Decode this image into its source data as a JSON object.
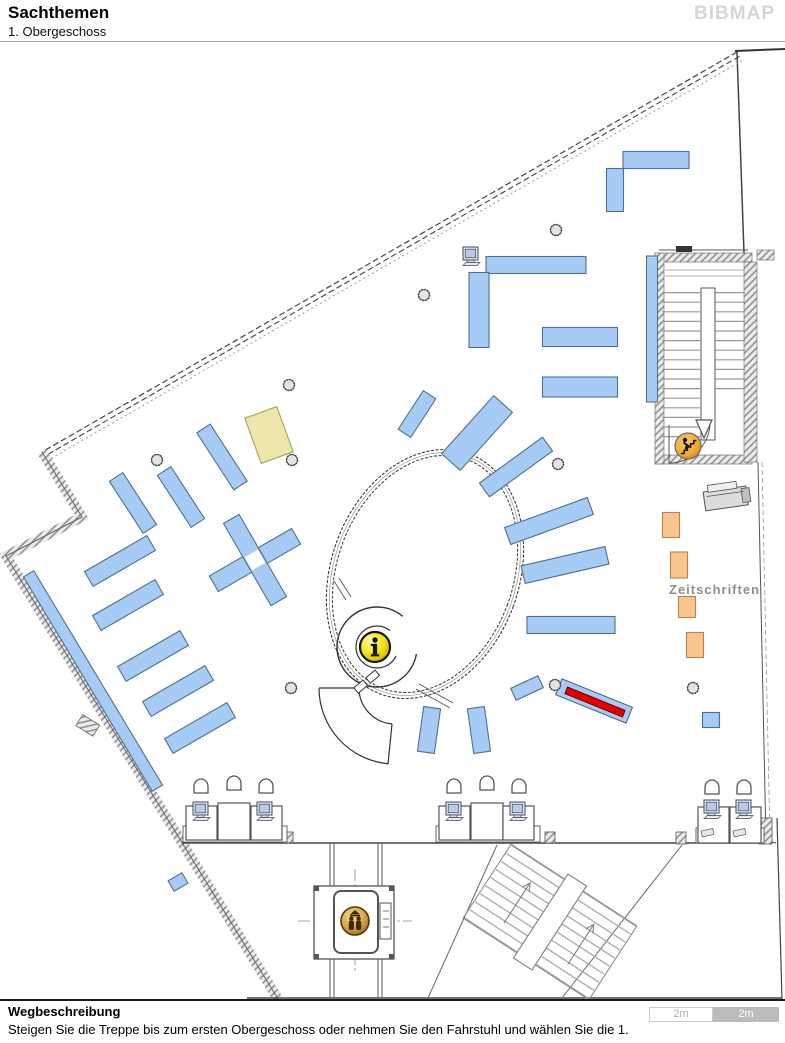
{
  "header": {
    "title": "Sachthemen",
    "subtitle": "1. Obergeschoss",
    "logo": "BIBMAP"
  },
  "footer": {
    "heading": "Wegbeschreibung",
    "instruction": "Steigen Sie die Treppe bis zum ersten Obergeschoss oder nehmen Sie den Fahrstuhl und wählen Sie die 1."
  },
  "scalebar": {
    "segments": [
      {
        "label": "2m",
        "style": "light"
      },
      {
        "label": "2m",
        "style": "dark"
      }
    ]
  },
  "map": {
    "palette": {
      "blue": {
        "fill": "#A6CCF5",
        "stroke": "#50708F"
      },
      "yellow": {
        "fill": "#EDE7AB",
        "stroke": "#A8A162"
      },
      "orange": {
        "fill": "#F9C68E",
        "stroke": "#B5854C"
      },
      "red": {
        "fill": "#E60000",
        "stroke": "#7A0000"
      },
      "white": {
        "fill": "#FFFFFF",
        "stroke": "#FFFFFF"
      }
    },
    "labels": {
      "zeitschriften": {
        "text": "Zeitschriften"
      }
    },
    "shelves": [
      {
        "x": 656,
        "y": 160,
        "w": 66,
        "h": 17,
        "r": 0,
        "type": "blue"
      },
      {
        "x": 615,
        "y": 190,
        "w": 17,
        "h": 43,
        "r": 0,
        "type": "blue"
      },
      {
        "x": 536,
        "y": 265,
        "w": 100,
        "h": 17,
        "r": 0,
        "type": "blue"
      },
      {
        "x": 479,
        "y": 310,
        "w": 20,
        "h": 75,
        "r": 0,
        "type": "blue"
      },
      {
        "x": 580,
        "y": 337,
        "w": 75,
        "h": 19,
        "r": 0,
        "type": "blue"
      },
      {
        "x": 580,
        "y": 387,
        "w": 75,
        "h": 20,
        "r": 0,
        "type": "blue"
      },
      {
        "x": 652,
        "y": 329,
        "w": 11,
        "h": 146,
        "r": 0,
        "type": "blue"
      },
      {
        "x": 417,
        "y": 414,
        "w": 15,
        "h": 46,
        "r": 33,
        "type": "blue"
      },
      {
        "x": 477,
        "y": 433,
        "w": 25,
        "h": 78,
        "r": 42,
        "type": "blue"
      },
      {
        "x": 516,
        "y": 467,
        "w": 17,
        "h": 78,
        "r": 54,
        "type": "blue"
      },
      {
        "x": 549,
        "y": 521,
        "w": 18,
        "h": 88,
        "r": 70,
        "type": "blue"
      },
      {
        "x": 565,
        "y": 565,
        "w": 18,
        "h": 86,
        "r": 77,
        "type": "blue"
      },
      {
        "x": 571,
        "y": 625,
        "w": 88,
        "h": 17,
        "r": 0,
        "type": "blue"
      },
      {
        "x": 527,
        "y": 688,
        "w": 13,
        "h": 30,
        "r": 65,
        "type": "blue"
      },
      {
        "x": 594,
        "y": 701,
        "w": 76,
        "h": 17,
        "r": 22,
        "type": "blue"
      },
      {
        "x": 595,
        "y": 702,
        "w": 62,
        "h": 7,
        "r": 22,
        "type": "red",
        "name": "highlighted-shelf-marker"
      },
      {
        "x": 429,
        "y": 730,
        "w": 17,
        "h": 45,
        "r": 8,
        "type": "blue"
      },
      {
        "x": 479,
        "y": 730,
        "w": 17,
        "h": 45,
        "r": -8,
        "type": "blue"
      },
      {
        "x": 133,
        "y": 503,
        "w": 16,
        "h": 62,
        "r": -33,
        "type": "blue"
      },
      {
        "x": 120,
        "y": 561,
        "w": 72,
        "h": 17,
        "r": -30,
        "type": "blue"
      },
      {
        "x": 181,
        "y": 497,
        "w": 16,
        "h": 62,
        "r": -33,
        "type": "blue"
      },
      {
        "x": 222,
        "y": 457,
        "w": 16,
        "h": 68,
        "r": -33,
        "type": "blue"
      },
      {
        "x": 269,
        "y": 435,
        "w": 34,
        "h": 48,
        "r": -20,
        "type": "yellow"
      },
      {
        "x": 128,
        "y": 605,
        "w": 72,
        "h": 17,
        "r": -30,
        "type": "blue"
      },
      {
        "x": 153,
        "y": 656,
        "w": 72,
        "h": 17,
        "r": -30,
        "type": "blue"
      },
      {
        "x": 178,
        "y": 691,
        "w": 72,
        "h": 17,
        "r": -30,
        "type": "blue"
      },
      {
        "x": 200,
        "y": 728,
        "w": 72,
        "h": 17,
        "r": -30,
        "type": "blue"
      },
      {
        "x": 93,
        "y": 681,
        "w": 12,
        "h": 250,
        "r": -31,
        "type": "blue"
      },
      {
        "x": 255,
        "y": 560,
        "w": 95,
        "h": 18,
        "r": -30,
        "type": "blue"
      },
      {
        "x": 255,
        "y": 560,
        "w": 18,
        "h": 95,
        "r": -30,
        "type": "blue"
      },
      {
        "x": 255,
        "y": 560,
        "w": 14,
        "h": 14,
        "r": -30,
        "type": "white"
      },
      {
        "x": 178,
        "y": 882,
        "w": 16,
        "h": 12,
        "r": -30,
        "type": "blue"
      },
      {
        "x": 711,
        "y": 720,
        "w": 17,
        "h": 15,
        "r": 0,
        "type": "blue"
      },
      {
        "x": 671,
        "y": 525,
        "w": 17,
        "h": 25,
        "r": 0,
        "type": "orange"
      },
      {
        "x": 679,
        "y": 565,
        "w": 17,
        "h": 26,
        "r": 0,
        "type": "orange"
      },
      {
        "x": 687,
        "y": 607,
        "w": 17,
        "h": 21,
        "r": 0,
        "type": "orange"
      },
      {
        "x": 695,
        "y": 645,
        "w": 17,
        "h": 25,
        "r": 0,
        "type": "orange"
      }
    ],
    "columns": [
      [
        556,
        230
      ],
      [
        424,
        295
      ],
      [
        289,
        385
      ],
      [
        157,
        460
      ],
      [
        292,
        460
      ],
      [
        558,
        464
      ],
      [
        291,
        688
      ],
      [
        555,
        685
      ],
      [
        693,
        688
      ]
    ],
    "desk_bases": [
      [
        183,
        826,
        104,
        16
      ],
      [
        436,
        826,
        104,
        16
      ],
      [
        696,
        828,
        68,
        15
      ]
    ],
    "desks": [
      [
        186,
        806,
        31,
        34
      ],
      [
        218,
        803,
        32,
        37
      ],
      [
        251,
        806,
        31,
        34
      ],
      [
        439,
        806,
        31,
        34
      ],
      [
        471,
        803,
        32,
        37
      ],
      [
        503,
        806,
        31,
        34
      ],
      [
        698,
        807,
        31,
        36
      ],
      [
        730,
        807,
        31,
        36
      ]
    ],
    "chairs": [
      [
        201,
        787
      ],
      [
        234,
        784
      ],
      [
        266,
        787
      ],
      [
        454,
        787
      ],
      [
        487,
        784
      ],
      [
        519,
        787
      ],
      [
        712,
        788
      ],
      [
        744,
        788
      ]
    ],
    "computers": [
      [
        472,
        257
      ],
      [
        202,
        812
      ],
      [
        266,
        812
      ],
      [
        455,
        812
      ],
      [
        519,
        812
      ],
      [
        713,
        810
      ],
      [
        745,
        810
      ]
    ],
    "keyboards": [
      [
        701,
        831
      ],
      [
        733,
        831
      ]
    ],
    "icons": [
      {
        "name": "info-icon",
        "x": 375,
        "y": 647
      },
      {
        "name": "elevator-icon",
        "x": 355,
        "y": 921
      },
      {
        "name": "stairs-up-icon",
        "x": 688,
        "y": 446
      }
    ]
  }
}
